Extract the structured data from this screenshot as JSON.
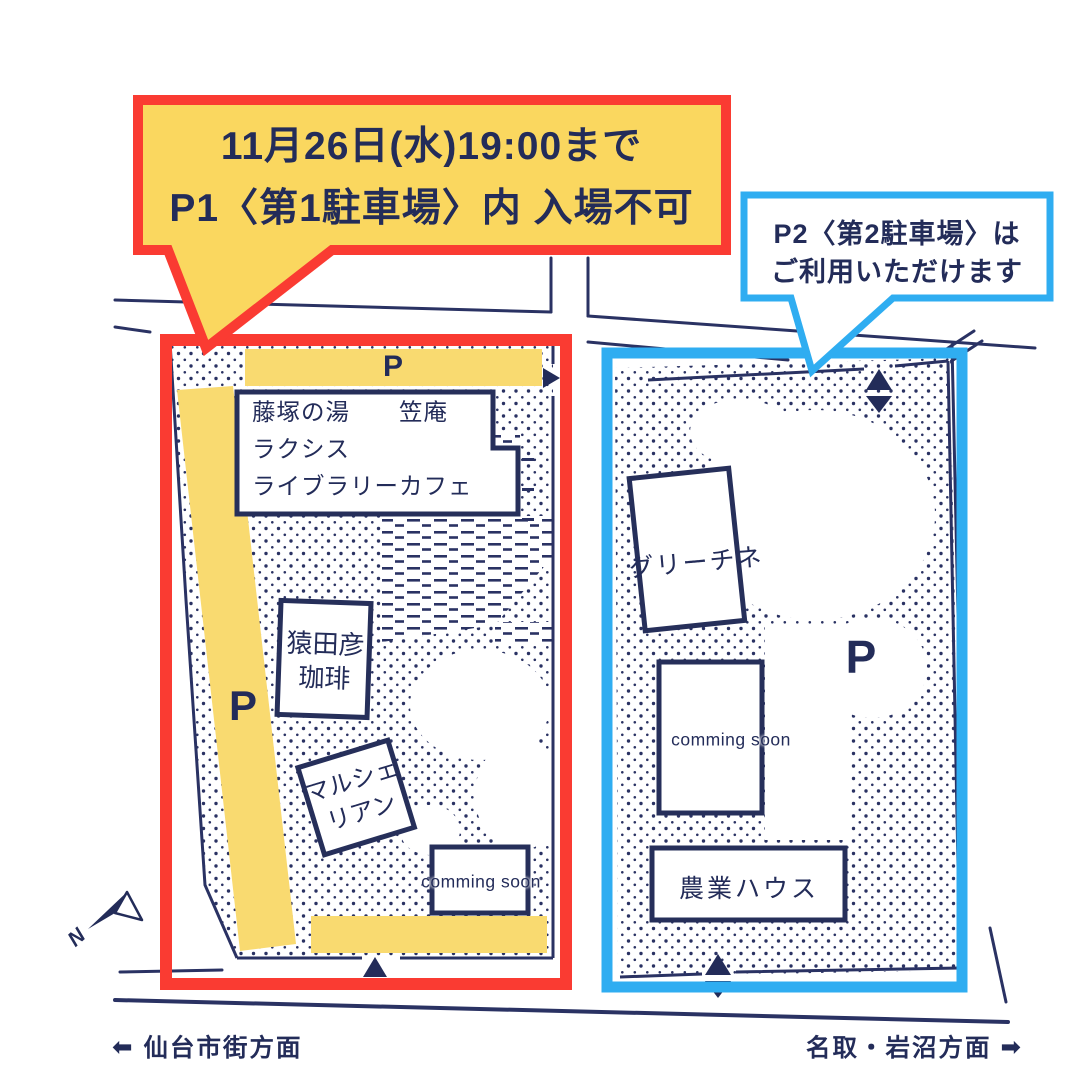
{
  "colors": {
    "navy": "#262F5A",
    "red": "#FA3B32",
    "blue": "#2FADF1",
    "callout_yellow": "#FAD75F",
    "parking_yellow": "#F9DA70"
  },
  "callout_p1": {
    "line1": "11月26日(水)19:00まで",
    "line2": "P1〈第1駐車場〉内 入場不可"
  },
  "callout_p2": {
    "line1": "P2〈第2駐車場〉は",
    "line2": "ご利用いただけます"
  },
  "p1": {
    "bar_label": "P",
    "strip_label": "P",
    "building_main": {
      "line1": "藤塚の湯　　笠庵",
      "line2": "ラクシス",
      "line3": "ライブラリーカフェ"
    },
    "building_coffee": {
      "line1": "猿田彦",
      "line2": "珈琲"
    },
    "building_marche": {
      "line1": "マルシェ",
      "line2": "リアン"
    },
    "building_coming": "comming soon"
  },
  "p2": {
    "area_label": "P",
    "building_greechine": "グリーチネ",
    "building_coming": "comming soon",
    "building_farm": "農業ハウス"
  },
  "directions": {
    "west": {
      "icon": "⬅",
      "label": "仙台市街方面"
    },
    "east": {
      "icon": "➡",
      "label": "名取・岩沼方面"
    }
  },
  "compass": {
    "label": "N"
  }
}
